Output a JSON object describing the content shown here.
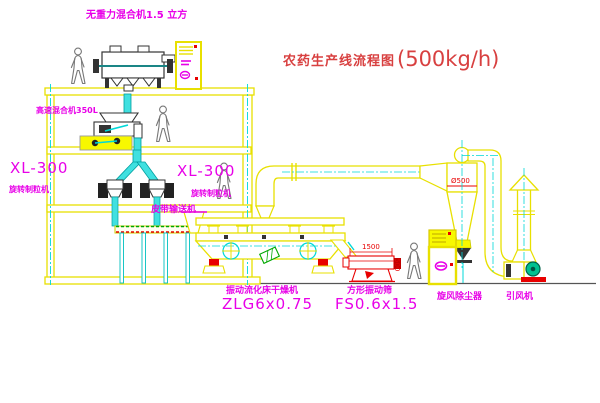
{
  "title": {
    "name": "农药生产线流程图",
    "capacity": "(500kg/h)"
  },
  "labels": {
    "top_mixer": "无重力混合机1.5 立方",
    "high_speed_mixer": "高速混合机350L",
    "granulator_left_model": "XL-300",
    "granulator_left_name": "旋转制粒机",
    "granulator_right_model": "XL-300",
    "granulator_right_name": "旋转制粒机",
    "belt_conveyor": "皮带输送机",
    "dryer_name": "振动流化床干燥机",
    "dryer_model": "ZLG6x0.75",
    "sieve_name": "方形振动筛",
    "sieve_model": "FS0.6x1.5",
    "cyclone": "旋风除尘器",
    "fan": "引风机"
  },
  "dimensions": {
    "sieve_length": "1500",
    "sieve_width": "500",
    "cyclone_diameter": "Ø500"
  },
  "colors": {
    "line_yellow": "#e8e000",
    "centerline_cyan": "#00d8d8",
    "label_magenta": "#e800e8",
    "title_red": "#d84040",
    "dim_red": "#e80000",
    "equipment_dark": "#333333",
    "person_gray": "#777777",
    "belt_green": "#00a800"
  }
}
